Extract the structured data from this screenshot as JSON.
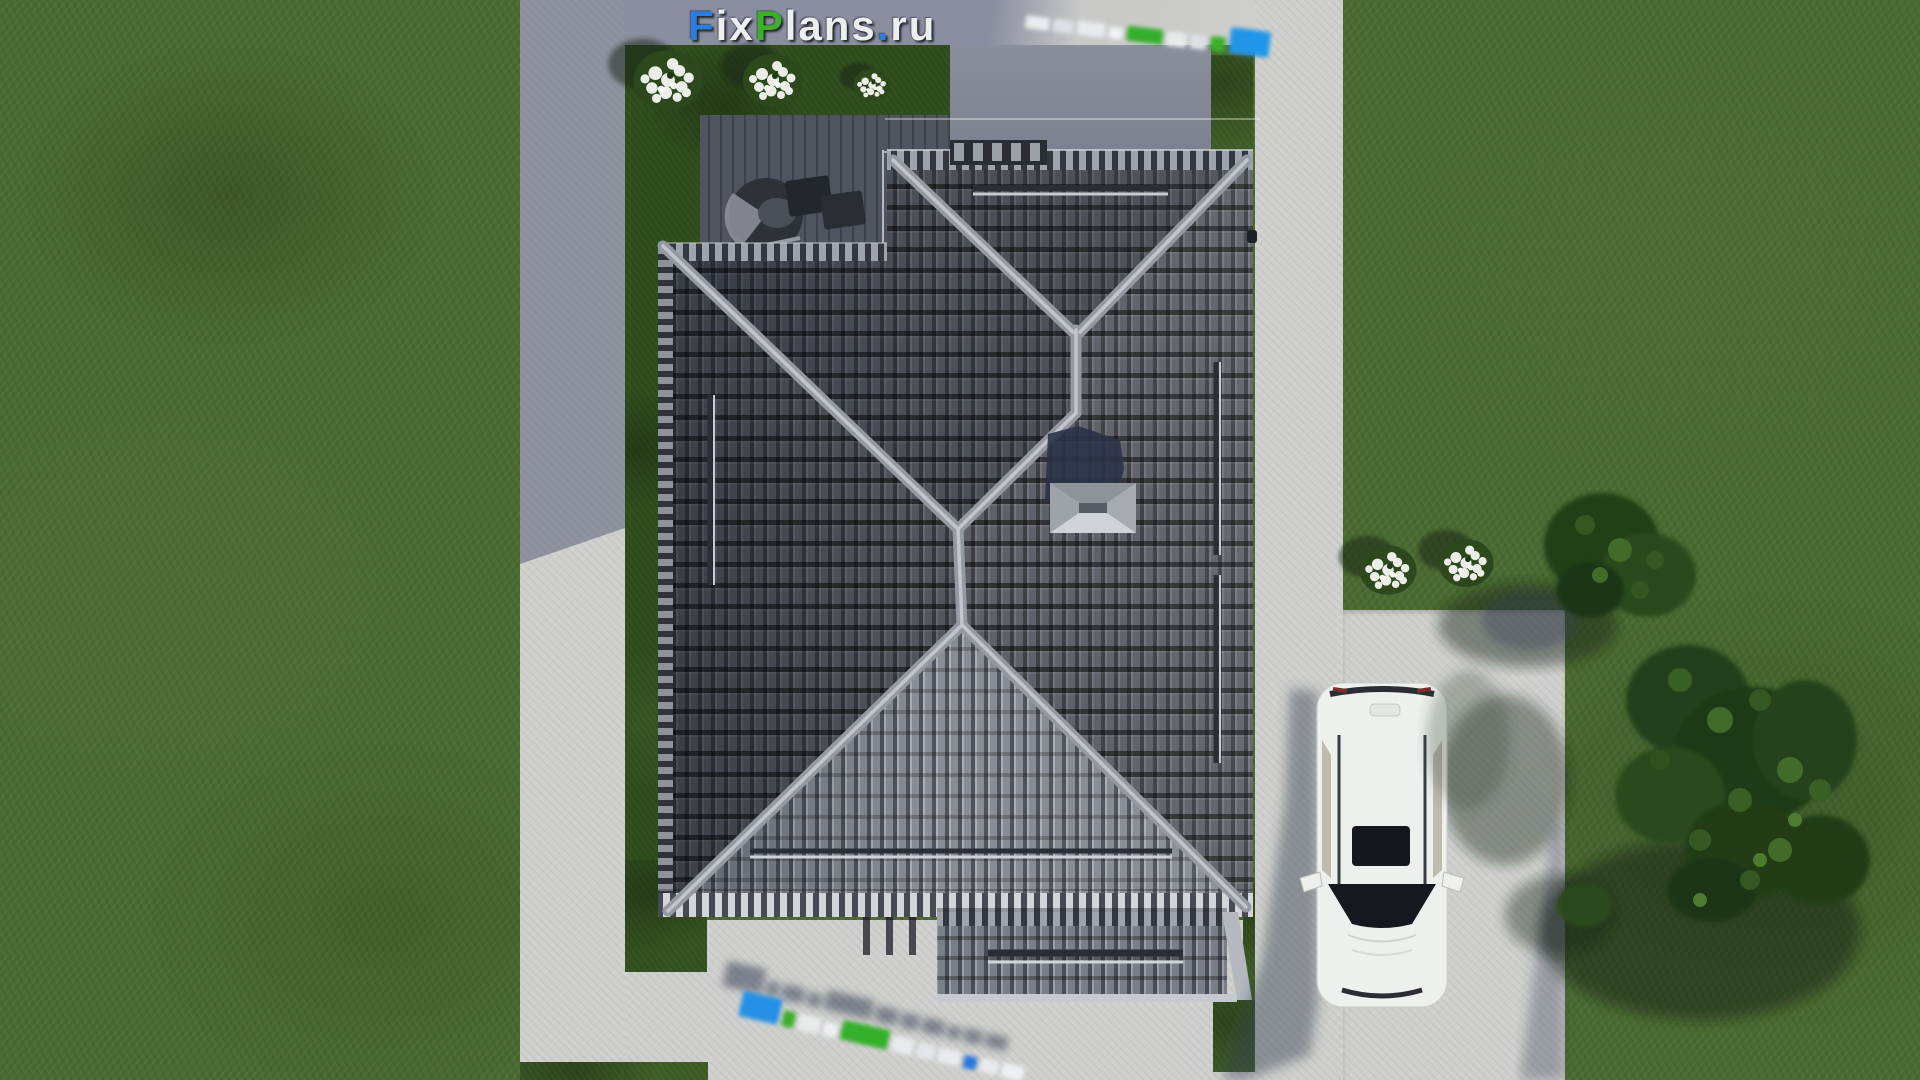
{
  "watermark_main": {
    "text": "FixPlans.ru",
    "segments": [
      {
        "text": "F",
        "color": "#2b7de2"
      },
      {
        "text": "ix",
        "color": "#eceef0"
      },
      {
        "text": "P",
        "color": "#3cb02a"
      },
      {
        "text": "lans",
        "color": "#eceef0"
      },
      {
        "text": ".",
        "color": "#2b7de2"
      },
      {
        "text": "ru",
        "color": "#eceef0"
      }
    ]
  },
  "watermark_top_right": {
    "blocks": [
      {
        "color": "#e8ebee",
        "w": 24,
        "h": 13
      },
      {
        "color": "#dde1e6",
        "w": 20,
        "h": 13
      },
      {
        "color": "#e8ebee",
        "w": 28,
        "h": 14
      },
      {
        "color": "#eff1f4",
        "w": 14,
        "h": 12
      },
      {
        "color": "#34af2b",
        "w": 36,
        "h": 15
      },
      {
        "color": "#e8ebee",
        "w": 20,
        "h": 14
      },
      {
        "color": "#dde1e6",
        "w": 16,
        "h": 14
      },
      {
        "color": "#3bae2a",
        "w": 15,
        "h": 15
      },
      {
        "color": "#2196e8",
        "w": 40,
        "h": 26
      }
    ]
  },
  "watermark_bottom": {
    "blocks": [
      {
        "color": "#2590e5",
        "w": 40,
        "h": 26
      },
      {
        "color": "#3bae2a",
        "w": 12,
        "h": 16
      },
      {
        "color": "#e8ebee",
        "w": 22,
        "h": 16
      },
      {
        "color": "#eef1f3",
        "w": 14,
        "h": 14
      },
      {
        "color": "#35b02c",
        "w": 48,
        "h": 20
      },
      {
        "color": "#e8ebee",
        "w": 22,
        "h": 16
      },
      {
        "color": "#e3e6ea",
        "w": 18,
        "h": 15
      },
      {
        "color": "#e8ebee",
        "w": 22,
        "h": 15
      },
      {
        "color": "#2b77dd",
        "w": 13,
        "h": 13
      },
      {
        "color": "#e8ebee",
        "w": 18,
        "h": 14
      },
      {
        "color": "#eef1f3",
        "w": 22,
        "h": 14
      }
    ],
    "shadow_color": "#3a4359"
  },
  "palette": {
    "grass": "#4b6a31",
    "yard_grass": "#32501e",
    "concrete_lit": "#cfd0cd",
    "concrete_shadow": "#868a99",
    "roof_base": "#5e6169",
    "roof_ridge": "#9599a1",
    "roof_south": "#8a8d95",
    "car_body": "#eef0ee",
    "tree_foliage": "#24411a",
    "flowers": "#eaeee6"
  }
}
